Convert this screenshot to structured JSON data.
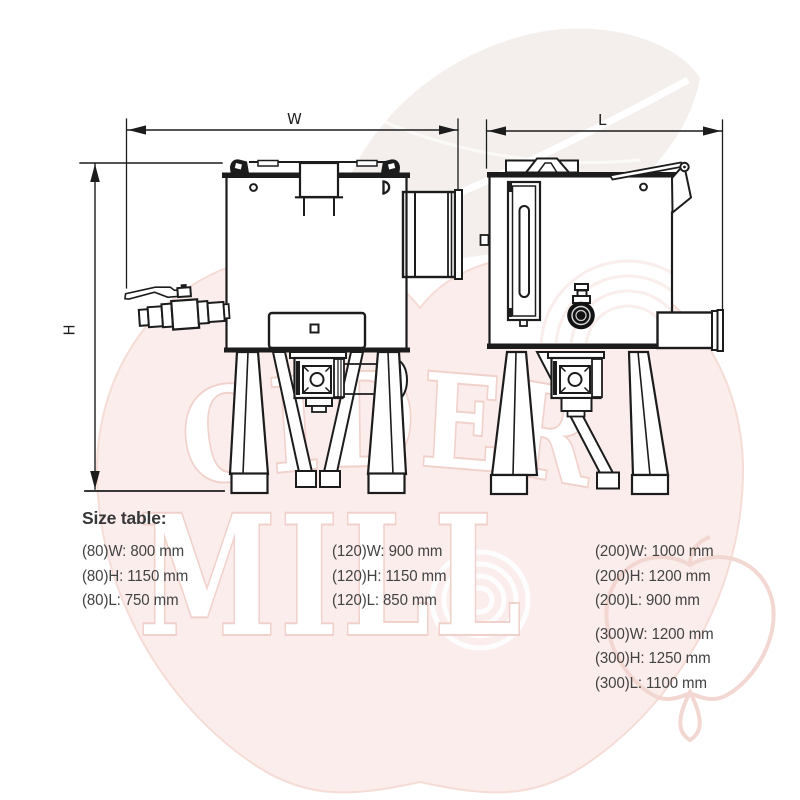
{
  "page": {
    "background": "#ffffff",
    "type": "technical dimension diagram"
  },
  "colors": {
    "line": "#1c1c1c",
    "heading_text": "#373737",
    "table_text": "#424242",
    "watermark_apple_fill": "#fbedeb",
    "watermark_outline_pink": "#f1d1cb",
    "watermark_leaf": "#f2ece8"
  },
  "watermark": {
    "word1": "CIDER",
    "word2": "MILL"
  },
  "dimension_labels": {
    "width": "W",
    "height": "H",
    "length": "L"
  },
  "size_table": {
    "heading": "Size table:",
    "columns": [
      {
        "groups": [
          {
            "rows": [
              "(80)W: 800 mm",
              "(80)H: 1150 mm",
              "(80)L: 750 mm"
            ]
          }
        ]
      },
      {
        "groups": [
          {
            "rows": [
              "(120)W: 900 mm",
              "(120)H: 1150 mm",
              "(120)L: 850 mm"
            ]
          }
        ]
      },
      {
        "groups": [
          {
            "rows": [
              "(200)W: 1000 mm",
              "(200)H: 1200 mm",
              "(200)L: 900 mm"
            ]
          },
          {
            "rows": [
              "(300)W: 1200 mm",
              "(300)H: 1250 mm",
              "(300)L: 1100 mm"
            ]
          }
        ]
      }
    ]
  }
}
